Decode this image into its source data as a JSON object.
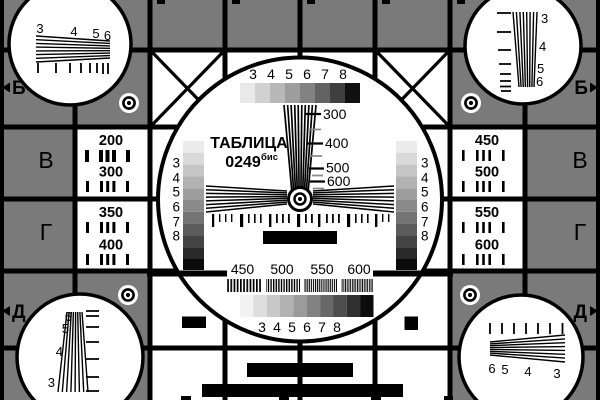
{
  "card": {
    "title": "ТАБЛИЦА",
    "code": "0249",
    "code_suffix": "бис"
  },
  "colors": {
    "background_gray": "#7a7a7a",
    "ink": "#000000",
    "tick_gray": "#8a8a8a"
  },
  "grayscale": {
    "top_labels": [
      "3",
      "4",
      "5",
      "6",
      "7",
      "8"
    ],
    "bottom_labels": [
      "3",
      "4",
      "5",
      "6",
      "7",
      "8"
    ],
    "left_labels": [
      "3",
      "4",
      "5",
      "6",
      "7",
      "8"
    ],
    "right_labels": [
      "3",
      "4",
      "5",
      "6",
      "7",
      "8"
    ],
    "top_steps": [
      "#e9e9e9",
      "#d1d1d1",
      "#b8b8b8",
      "#9e9e9e",
      "#828282",
      "#626262",
      "#3f3f3f",
      "#101010"
    ],
    "side_steps": [
      "#ececec",
      "#dadada",
      "#c6c6c6",
      "#b2b2b2",
      "#9e9e9e",
      "#8a8a8a",
      "#747474",
      "#5c5c5c",
      "#434343",
      "#2a2a2a",
      "#0b0b0b"
    ],
    "bottom_steps": [
      "#f2f2f2",
      "#dedede",
      "#c8c8c8",
      "#b2b2b2",
      "#9b9b9b",
      "#828282",
      "#686868",
      "#4d4d4d",
      "#303030",
      "#0c0c0c"
    ]
  },
  "frequency_scale": {
    "labels": [
      "300",
      "400",
      "500",
      "600"
    ]
  },
  "burst": {
    "labels": [
      "450",
      "500",
      "550",
      "600"
    ]
  },
  "left_panel": {
    "values": [
      "200",
      "300",
      "350",
      "400"
    ]
  },
  "right_panel": {
    "values": [
      "450",
      "500",
      "550",
      "600"
    ]
  },
  "row_markers": {
    "left_top": "Б",
    "left_bottom": "Д",
    "right_top": "Б",
    "right_bottom": "Д",
    "left_letters": [
      "В",
      "Г"
    ],
    "right_letters": [
      "В",
      "Г"
    ]
  },
  "corner_wedges": {
    "top_left": [
      "3",
      "4",
      "5",
      "6"
    ],
    "top_right": [
      "3",
      "4",
      "5",
      "6"
    ],
    "bottom_left": [
      "6",
      "5",
      "4",
      "3"
    ],
    "bottom_right": [
      "6",
      "5",
      "4",
      "3"
    ]
  }
}
